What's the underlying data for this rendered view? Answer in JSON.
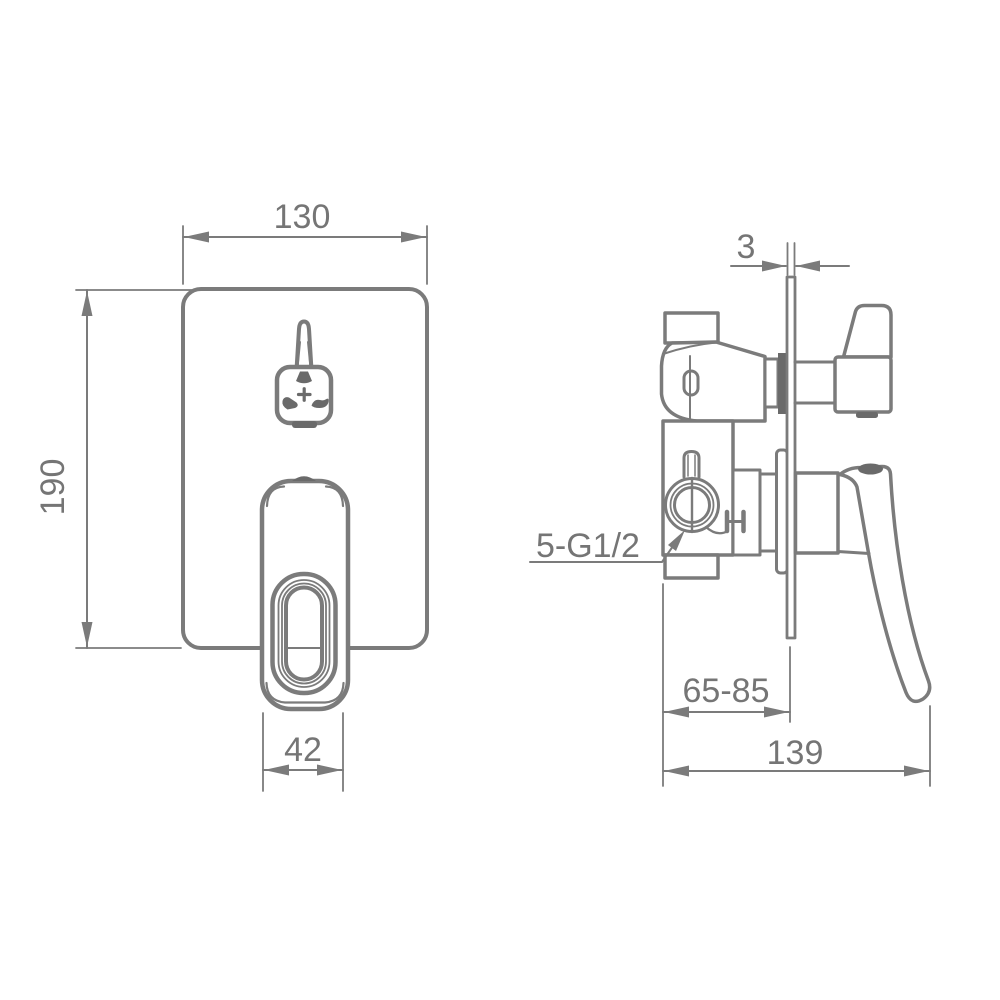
{
  "dimensions": {
    "front_width": "130",
    "front_height": "190",
    "handle_width": "42",
    "plate_thickness": "3",
    "depth_range": "65-85",
    "total_depth": "139",
    "connection_label": "5-G1/2"
  },
  "icons": {
    "diverter_icons": [
      "shower-icon",
      "plus-icon",
      "handshower-icon",
      "spout-icon"
    ]
  },
  "colors": {
    "line": "#7b7b7b",
    "dark_fill": "#6a6a6a",
    "text": "#757575",
    "background": "#ffffff"
  }
}
